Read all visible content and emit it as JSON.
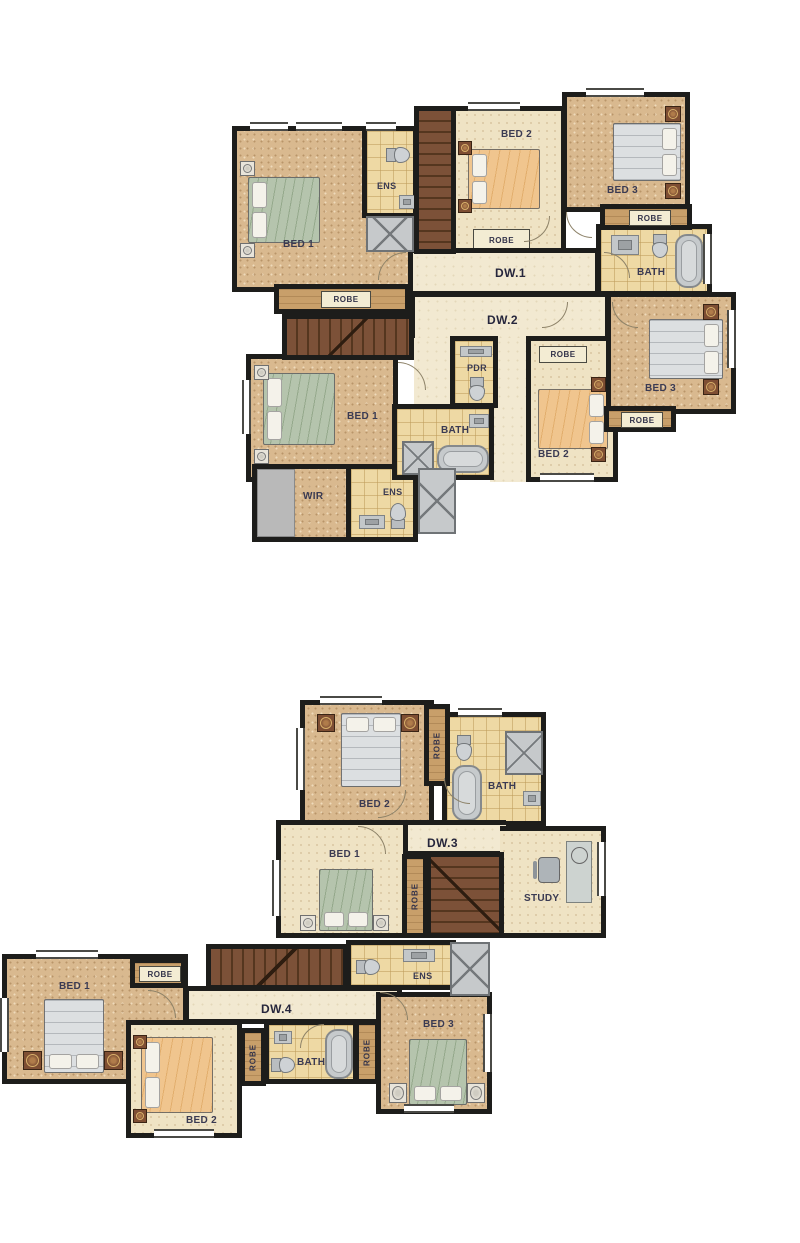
{
  "palette": {
    "wall": "#1d1d1b",
    "carpet": "#d9b98f",
    "carpet_light": "#efe3c4",
    "tile": "#eed9a4",
    "hall": "#f2e9d1",
    "robe": "#c89f6a",
    "stair": "#7c5138",
    "fixture_gray": "#c6c9cb",
    "bed_green": "#b5c4ad",
    "bed_peach": "#f0c58e",
    "bed_gray": "#dcdfe1",
    "label_color": "#3a3a52"
  },
  "plans": [
    {
      "id": "dw1",
      "hall_label": "DW.1",
      "rooms": {
        "bed1": "BED 1",
        "bed1_robe": "ROBE",
        "ens": "ENS",
        "bed2": "BED 2",
        "bed2_robe": "ROBE",
        "bed3": "BED 3",
        "bed3_robe": "ROBE",
        "bath": "BATH"
      }
    },
    {
      "id": "dw2",
      "hall_label": "DW.2",
      "rooms": {
        "bed1": "BED 1",
        "wir": "WIR",
        "ens": "ENS",
        "bath": "BATH",
        "pdr": "PDR",
        "bed2": "BED 2",
        "bed2_robe": "ROBE",
        "bed3": "BED 3",
        "bed3_robe": "ROBE"
      }
    },
    {
      "id": "dw3",
      "hall_label": "DW.3",
      "rooms": {
        "bed2": "BED 2",
        "bed2_robe": "ROBE",
        "bath": "BATH",
        "bed1": "BED 1",
        "bed1_robe": "ROBE",
        "study": "STUDY"
      }
    },
    {
      "id": "dw4",
      "hall_label": "DW.4",
      "rooms": {
        "bed1": "BED 1",
        "bed1_robe": "ROBE",
        "ens": "ENS",
        "bed2": "BED 2",
        "bed2_robe": "ROBE",
        "bath": "BATH",
        "bath_robe": "ROBE",
        "bed3": "BED 3"
      }
    }
  ]
}
